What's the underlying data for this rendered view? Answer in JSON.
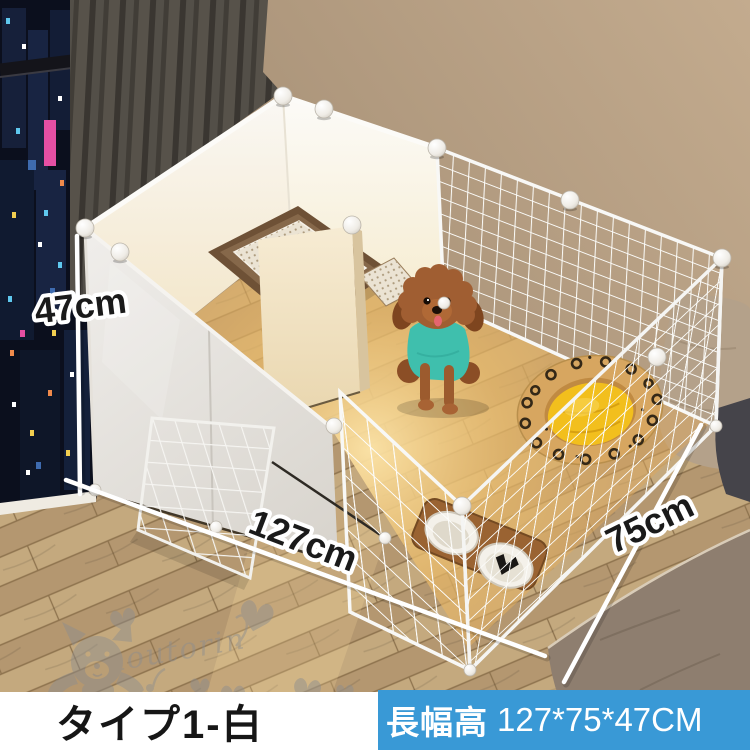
{
  "scene": {
    "dimensions": {
      "height": "47cm",
      "length": "127cm",
      "width": "75cm"
    },
    "watermark": {
      "brand": "koutorin"
    }
  },
  "footer": {
    "type_label": "タイプ1-白",
    "size_prefix": "長幅高",
    "size_value": "127*75*47CM"
  },
  "colors": {
    "banner_blue": "#3999D6",
    "banner_text": "#FFFFFF",
    "type_text": "#161616",
    "floor_wood": "#BC9F76",
    "wall_tan": "#B3A085",
    "panel_white": "#EFEDEA",
    "mesh_white": "#FBFBF9",
    "dog_fur": "#A05E32",
    "dog_shirt": "#3FBFAD",
    "bed_rim": "#D7A660",
    "bed_cushion": "#F2BF1D",
    "litter_tray": "#7D5F42",
    "curtain_gray": "#57524B",
    "night_window": "#0B0F1D",
    "watermark_gray": "#8E8E8E",
    "dimension_line": "#FFFFFF",
    "dimension_text": "#1A1A1A"
  }
}
